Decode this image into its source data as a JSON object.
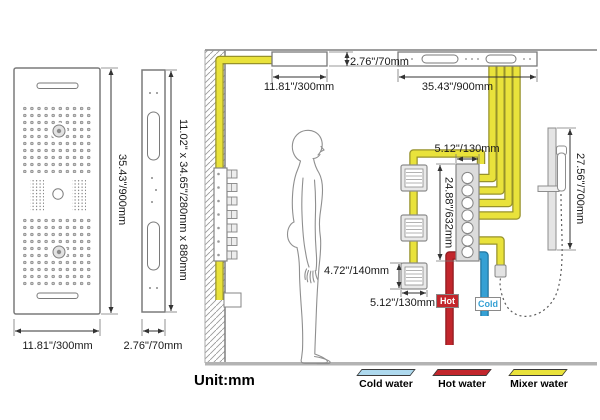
{
  "views": {
    "front_height": "35.43\"/900mm",
    "front_width": "11.81\"/300mm",
    "side_width": "2.76\"/70mm",
    "side_dims": "11.02\" x 34.65\"/280mm x 880mm"
  },
  "install": {
    "panel_thickness": "2.76\"/70mm",
    "panel_left_width": "11.81\"/300mm",
    "panel_right_width": "35.43\"/900mm",
    "valve_width": "5.12\"/130mm",
    "valve_height": "24.88\"/632mm",
    "jet_height": "4.72\"/140mm",
    "jet_width": "5.12\"/130mm",
    "bar_height": "27.56\"/700mm",
    "hot": "Hot",
    "cold": "Cold"
  },
  "footer": {
    "unit": "Unit:mm",
    "legend": [
      {
        "label": "Cold water",
        "color": "#aed9ee"
      },
      {
        "label": "Hot water",
        "color": "#c2262c"
      },
      {
        "label": "Mixer water",
        "color": "#e9e23b"
      }
    ]
  },
  "colors": {
    "mixer_pipe": "#e9e23b",
    "hot_pipe": "#c2262c",
    "cold_pipe": "#35a0d4"
  }
}
